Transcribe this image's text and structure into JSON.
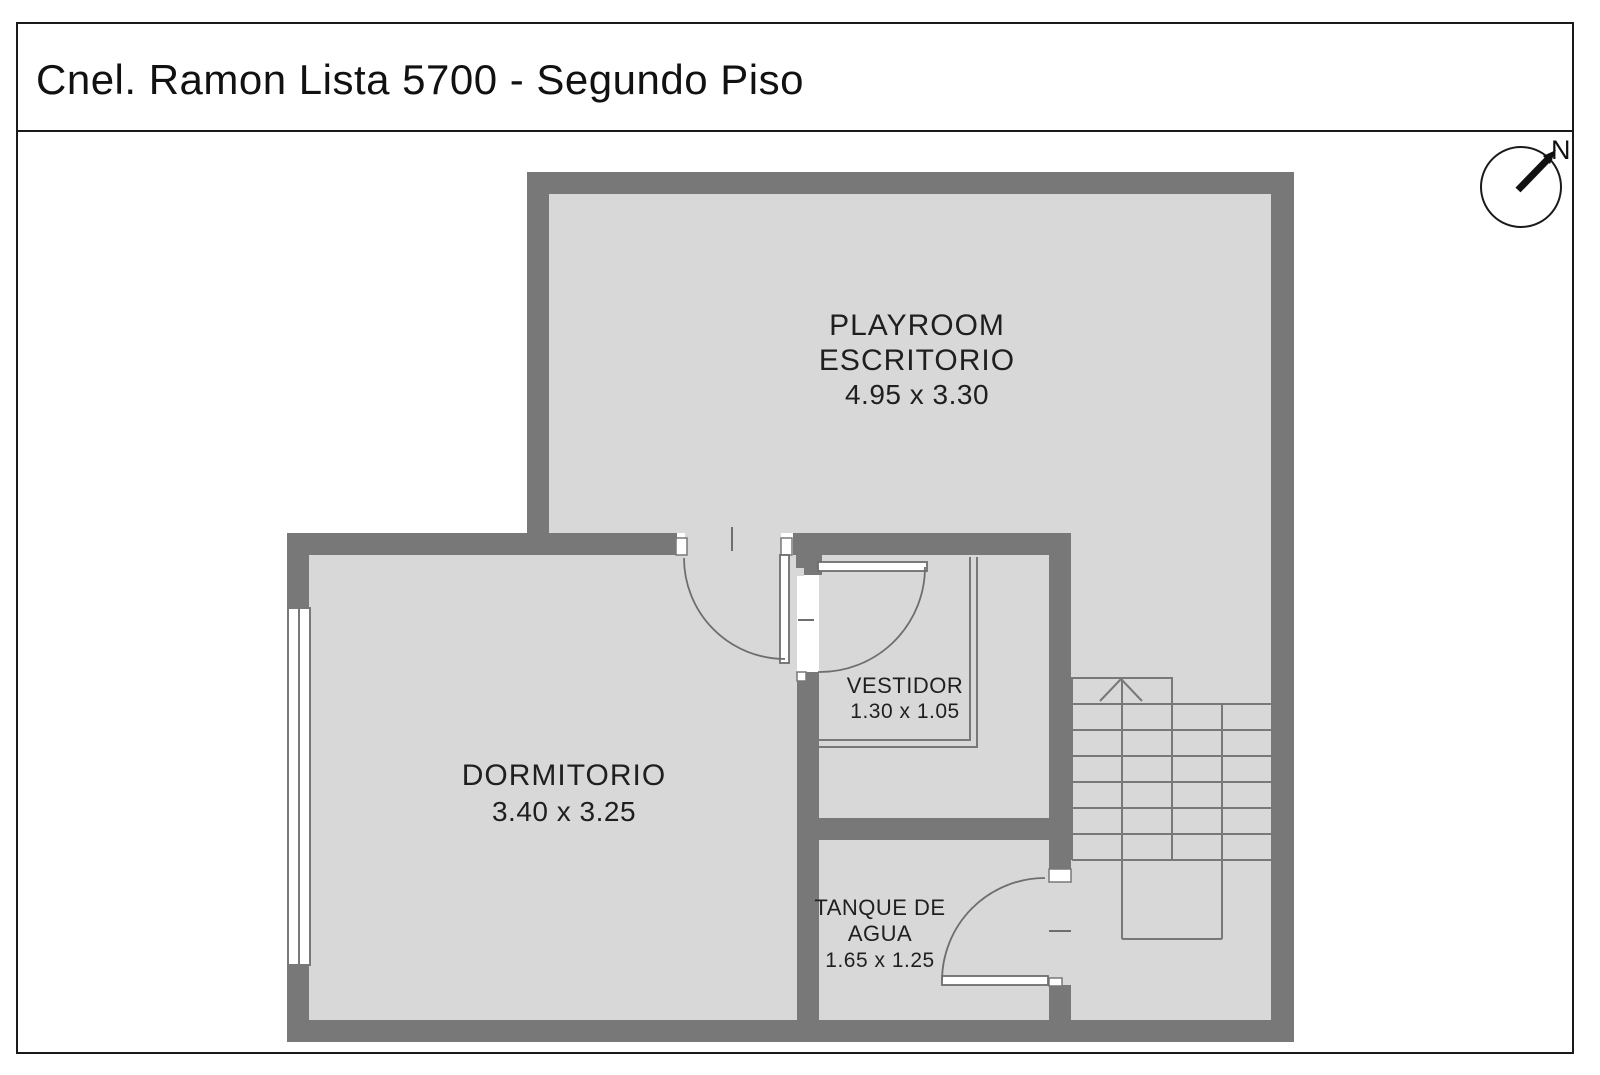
{
  "header": {
    "title": "Cnel. Ramon Lista 5700 - Segundo Piso"
  },
  "compass": {
    "label": "N"
  },
  "rooms": {
    "playroom": {
      "name_line1": "PLAYROOM",
      "name_line2": "ESCRITORIO",
      "dims": "4.95 x 3.30"
    },
    "dormitorio": {
      "name": "DORMITORIO",
      "dims": "3.40 x 3.25"
    },
    "vestidor": {
      "name": "VESTIDOR",
      "dims": "1.30 x 1.05"
    },
    "tanque_de_agua": {
      "name_line1": "TANQUE DE",
      "name_line2": "AGUA",
      "dims": "1.65 x 1.25"
    }
  },
  "colors": {
    "wall": "#787878",
    "floor": "#d8d8d8",
    "line": "#6e6e6e",
    "text": "#1f1f1f",
    "background": "#ffffff"
  }
}
